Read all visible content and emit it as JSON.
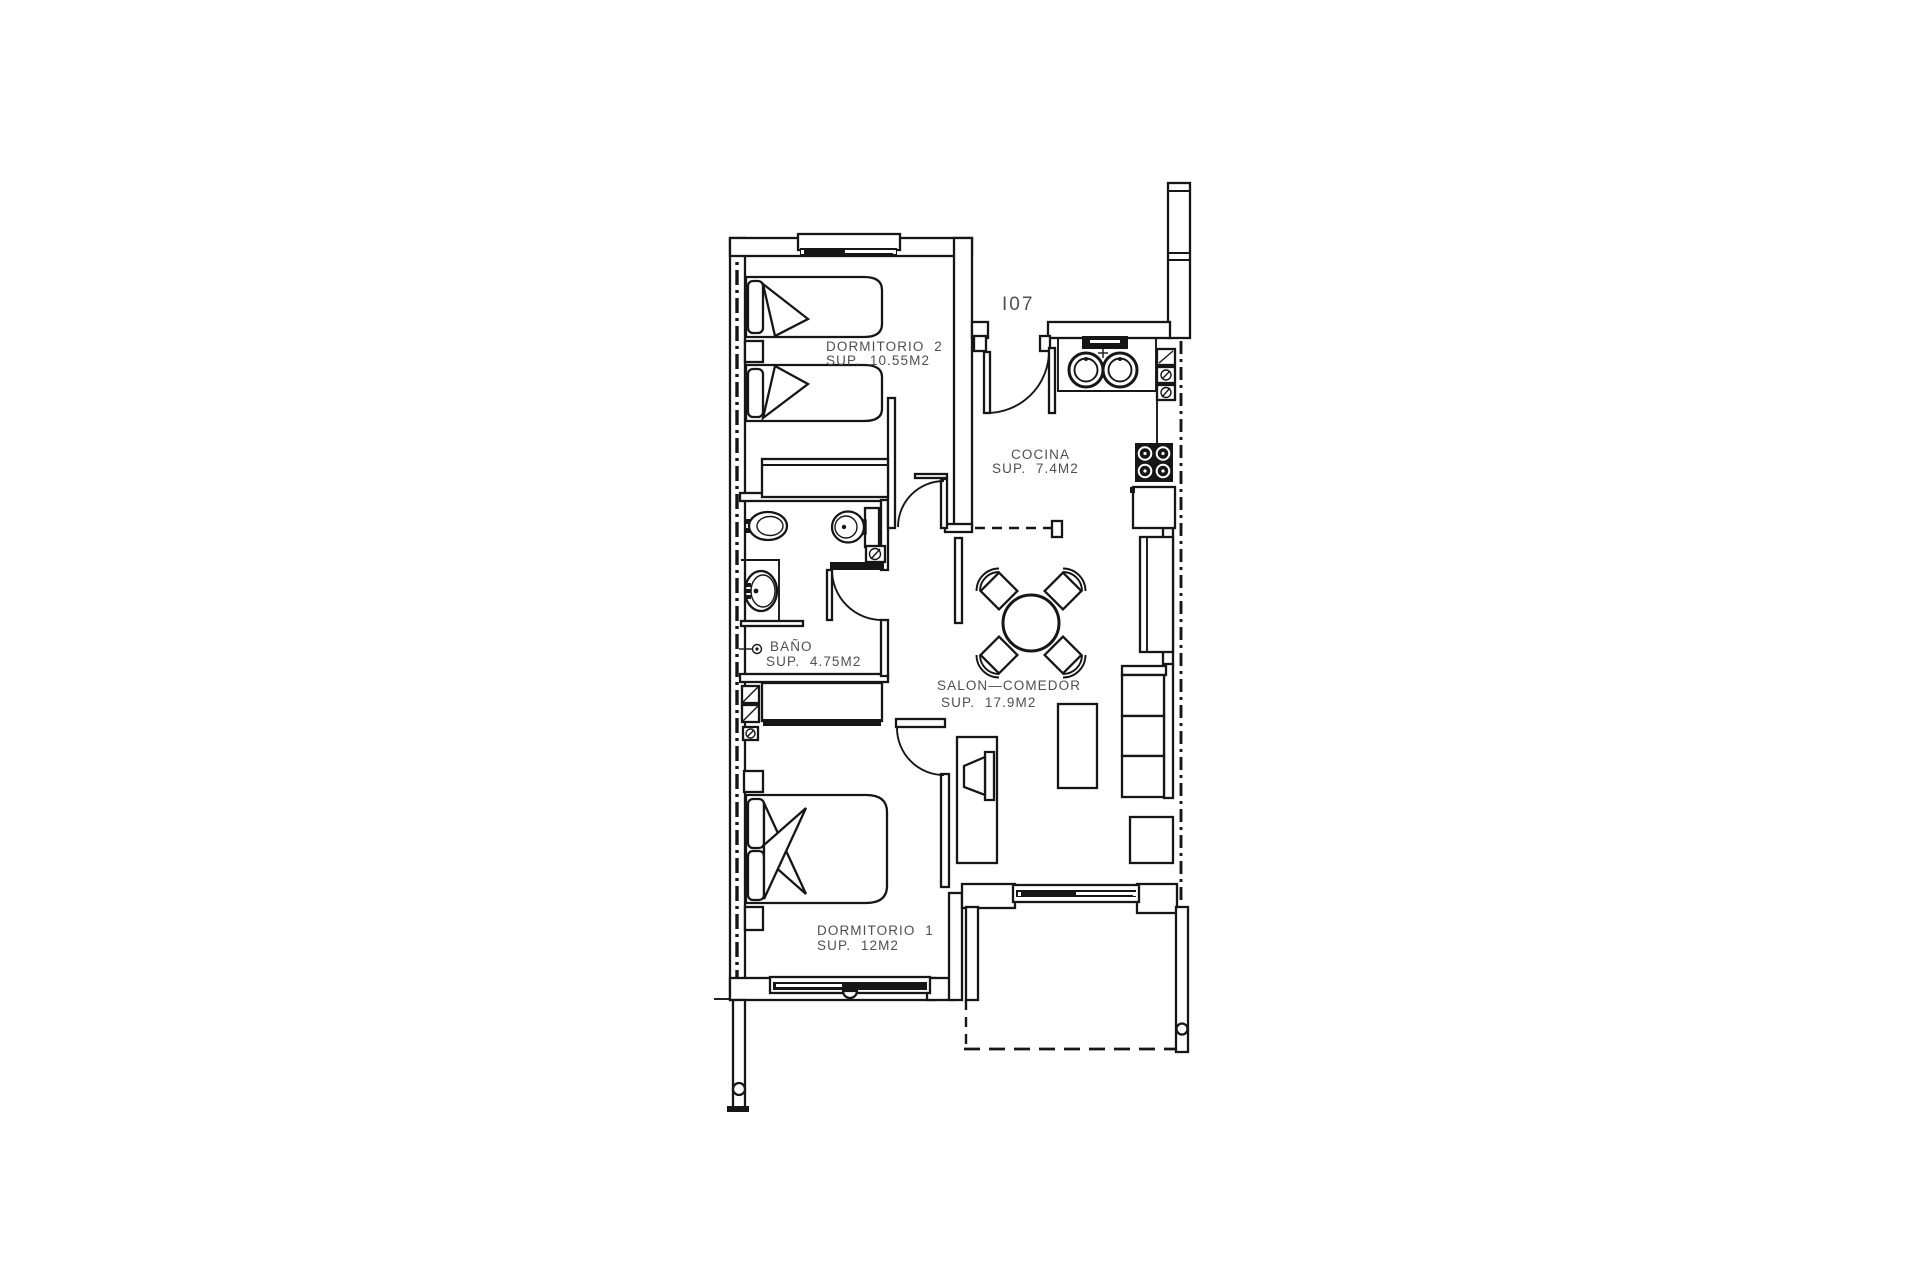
{
  "unit_label": "I07",
  "rooms": {
    "dormitorio2": {
      "name": "DORMITORIO  2",
      "area": "SUP.  10.55M2"
    },
    "cocina": {
      "name": "COCINA",
      "area": "SUP.  7.4M2"
    },
    "bano": {
      "name": "BAÑO",
      "area": "SUP.  4.75M2"
    },
    "salon": {
      "name": "SALON—COMEDOR",
      "area": "SUP.  17.9M2"
    },
    "dormitorio1": {
      "name": "DORMITORIO  1",
      "area": "SUP.  12M2"
    }
  },
  "colors": {
    "line": "#161616",
    "text": "#4f4f4f",
    "background": "#ffffff"
  }
}
